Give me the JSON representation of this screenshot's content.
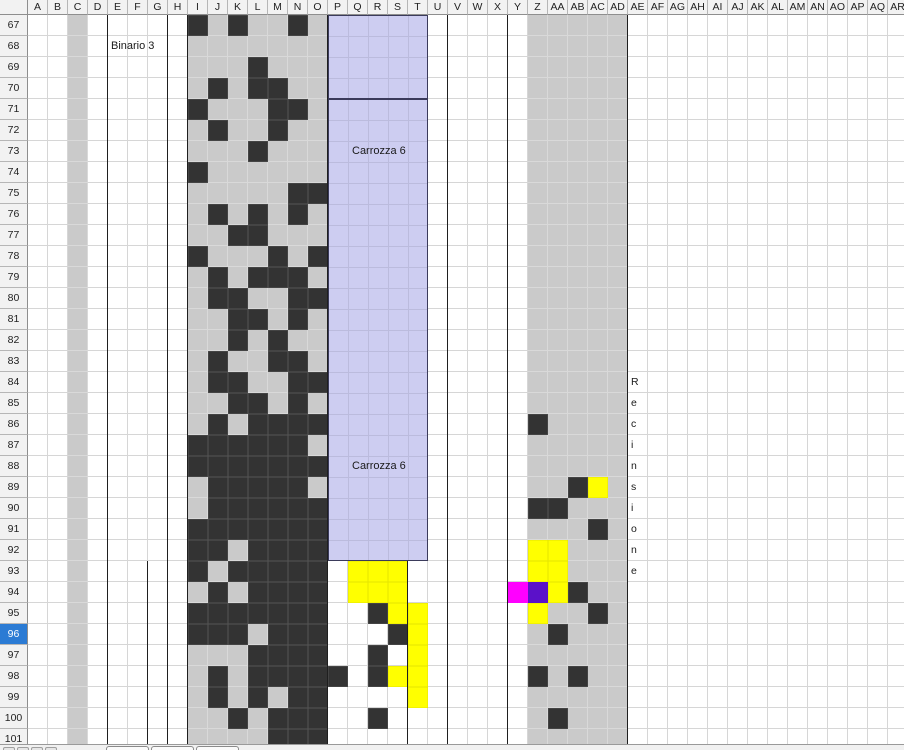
{
  "window": {
    "width": 904,
    "height": 750
  },
  "grid": {
    "columns": [
      "A",
      "B",
      "C",
      "D",
      "E",
      "F",
      "G",
      "H",
      "I",
      "J",
      "K",
      "L",
      "M",
      "N",
      "O",
      "P",
      "Q",
      "R",
      "S",
      "T",
      "U",
      "V",
      "W",
      "X",
      "Y",
      "Z",
      "AA",
      "AB",
      "AC",
      "AD",
      "AE",
      "AF",
      "AG",
      "AH",
      "AI",
      "AJ",
      "AK",
      "AL",
      "AM",
      "AN",
      "AO",
      "AP",
      "AQ",
      "AR"
    ],
    "row_start": 67,
    "row_end": 101,
    "selected_row": 96,
    "col_width": 20,
    "row_height": 21,
    "row_header_width": 28,
    "col_header_height": 15
  },
  "labels": {
    "binario": "Binario 3",
    "carrozza_top": "Carrozza 6",
    "carrozza_bottom": "Carrozza 6"
  },
  "vertical_text": {
    "column": "AE",
    "row_start": 84,
    "text": "Recinsione"
  },
  "regions": {
    "gray": [
      {
        "col_start": "C",
        "col_end": "C"
      },
      {
        "col_start": "I",
        "col_end": "O"
      },
      {
        "col_start": "Z",
        "col_end": "AD"
      }
    ],
    "carriage_box": {
      "col_start": "P",
      "col_end": "T",
      "row_start": 67,
      "row_end": 92,
      "divider_after_row": 70
    }
  },
  "cells": {
    "dark": [
      "I67",
      "K67",
      "N67",
      "L69",
      "J70",
      "L70",
      "M70",
      "I71",
      "M71",
      "N71",
      "J72",
      "M72",
      "L73",
      "I74",
      "N75",
      "O75",
      "J76",
      "L76",
      "N76",
      "K77",
      "L77",
      "I78",
      "M78",
      "O78",
      "J79",
      "L79",
      "M79",
      "N79",
      "J80",
      "K80",
      "N80",
      "O80",
      "K81",
      "L81",
      "N81",
      "K82",
      "M82",
      "J83",
      "M83",
      "N83",
      "J84",
      "K84",
      "N84",
      "O84",
      "K85",
      "L85",
      "N85",
      "J86",
      "L86",
      "M86",
      "N86",
      "O86",
      "I87",
      "J87",
      "K87",
      "L87",
      "M87",
      "N87",
      "I88",
      "J88",
      "K88",
      "L88",
      "M88",
      "N88",
      "O88",
      "J89",
      "K89",
      "L89",
      "M89",
      "N89",
      "J90",
      "K90",
      "L90",
      "M90",
      "N90",
      "O90",
      "I91",
      "J91",
      "K91",
      "L91",
      "M91",
      "N91",
      "O91",
      "I92",
      "J92",
      "L92",
      "M92",
      "N92",
      "O92",
      "I93",
      "K93",
      "L93",
      "M93",
      "N93",
      "O93",
      "J94",
      "L94",
      "M94",
      "N94",
      "O94",
      "I95",
      "J95",
      "K95",
      "L95",
      "M95",
      "N95",
      "O95",
      "I96",
      "J96",
      "K96",
      "M96",
      "N96",
      "O96",
      "L97",
      "M97",
      "N97",
      "O97",
      "J98",
      "L98",
      "M98",
      "N98",
      "O98",
      "J99",
      "L99",
      "N99",
      "O99",
      "K100",
      "M100",
      "N100",
      "O100",
      "M101",
      "N101",
      "O101",
      "R95",
      "S96",
      "R97",
      "P98",
      "R98",
      "R100",
      "Z86",
      "AB89",
      "Z90",
      "AA90",
      "AC91",
      "AB94",
      "AC95",
      "AA96",
      "Z98",
      "AB98",
      "AA100"
    ],
    "yellow": [
      "Q93",
      "R93",
      "S93",
      "Q94",
      "R94",
      "S94",
      "S95",
      "T95",
      "T96",
      "T97",
      "S98",
      "T98",
      "T99",
      "AC89",
      "Z92",
      "AA92",
      "Z93",
      "AA93",
      "AA94",
      "Z95"
    ],
    "magenta": [
      "Y94"
    ],
    "purple": [
      "Z94"
    ]
  },
  "border_lines": [
    {
      "col": "E",
      "row_start": 67,
      "row_end": 101
    },
    {
      "col": "G",
      "row_start": 93,
      "row_end": 101
    },
    {
      "col": "H",
      "row_start": 67,
      "row_end": 101
    },
    {
      "col": "I",
      "row_start": 67,
      "row_end": 101
    },
    {
      "col": "P",
      "row_start": 67,
      "row_end": 101
    },
    {
      "col": "T",
      "row_start": 93,
      "row_end": 101
    },
    {
      "col": "V",
      "row_start": 67,
      "row_end": 101
    },
    {
      "col": "Y",
      "row_start": 67,
      "row_end": 101
    },
    {
      "col": "AE",
      "row_start": 67,
      "row_end": 101
    }
  ],
  "colors": {
    "dark_cell": "#333333",
    "yellow": "#ffff00",
    "magenta": "#ff00ff",
    "purple": "#5b11c9",
    "gray_fill": "#cacaca",
    "lavender_fill": "#cdcdf1",
    "lavender_border": "#3b3b5b",
    "selected_header_bg": "#2b7bd4",
    "border_line": "#1f1f1f"
  },
  "sheet_tabs": {
    "nav_button_count": 4,
    "visible_tab_count": 3
  }
}
